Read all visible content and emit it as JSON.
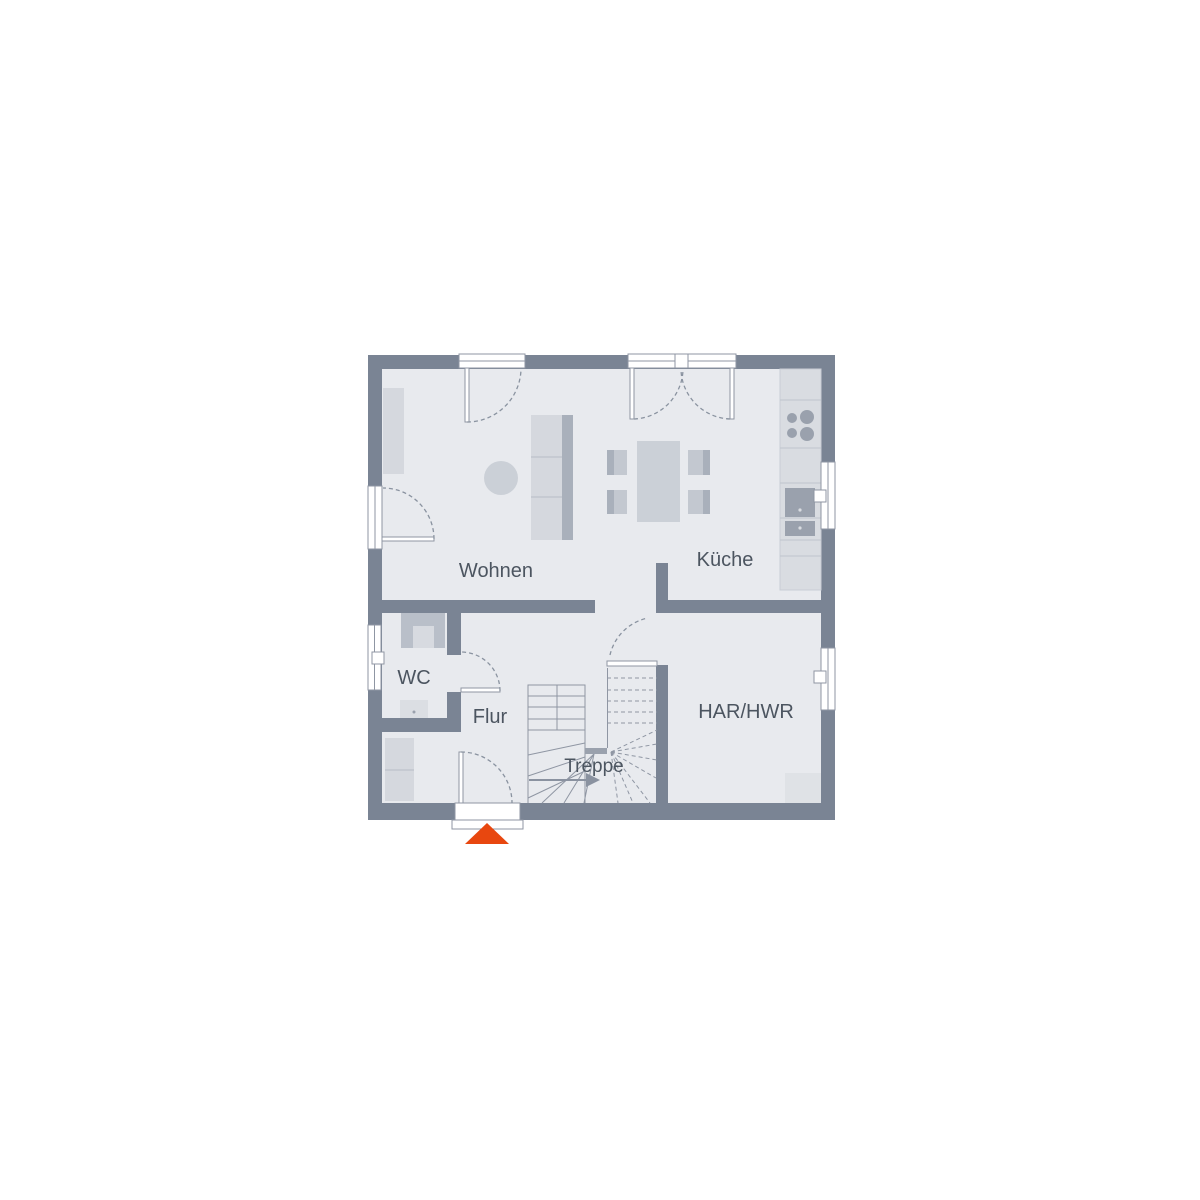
{
  "plan": {
    "type": "floorplan",
    "rooms": {
      "wohnen": {
        "label": "Wohnen"
      },
      "kueche": {
        "label": "Küche"
      },
      "wc": {
        "label": "WC"
      },
      "flur": {
        "label": "Flur"
      },
      "treppe": {
        "label": "Treppe"
      },
      "har_hwr": {
        "label": "HAR/HWR"
      }
    },
    "icons": {
      "entrance_marker": "triangle-up",
      "stair_direction": "arrow-right",
      "stove": "four-burner-cooktop"
    },
    "colors": {
      "wall": "#7A8494",
      "floor": "#E8EAEE",
      "furniture_light": "#D5D8DE",
      "furniture_mid": "#C3C8D0",
      "furniture_dark": "#9AA1AD",
      "outline": "#8F96A3",
      "label_text": "#4C5560",
      "entrance_marker": "#E8470F",
      "background": "#FFFFFF"
    }
  }
}
